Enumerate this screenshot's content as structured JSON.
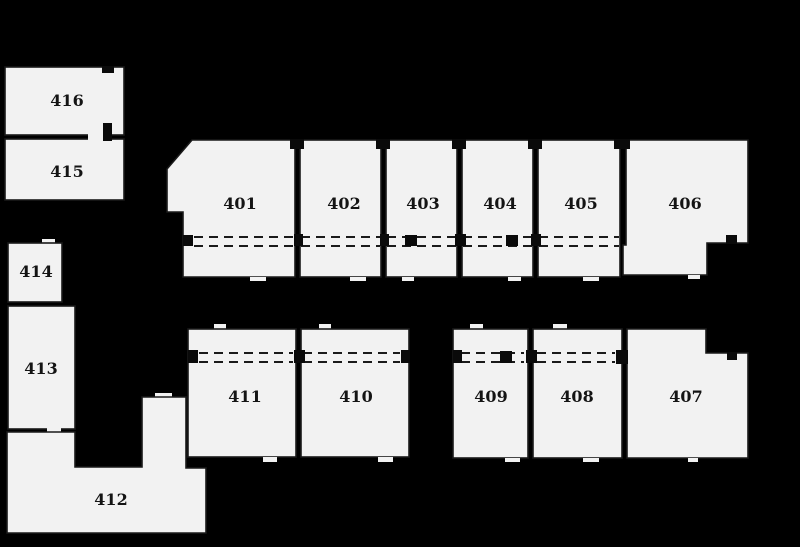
{
  "plan": {
    "type": "floor-plan",
    "units": [
      {
        "number": "401"
      },
      {
        "number": "402"
      },
      {
        "number": "403"
      },
      {
        "number": "404"
      },
      {
        "number": "405"
      },
      {
        "number": "406"
      },
      {
        "number": "407"
      },
      {
        "number": "408"
      },
      {
        "number": "409"
      },
      {
        "number": "410"
      },
      {
        "number": "411"
      },
      {
        "number": "412"
      },
      {
        "number": "413"
      },
      {
        "number": "414"
      },
      {
        "number": "415"
      },
      {
        "number": "416"
      }
    ],
    "colors": {
      "background": "#000000",
      "room_fill": "#f2f2f2",
      "wall": "#1a1a1a",
      "label": "#141414"
    }
  }
}
